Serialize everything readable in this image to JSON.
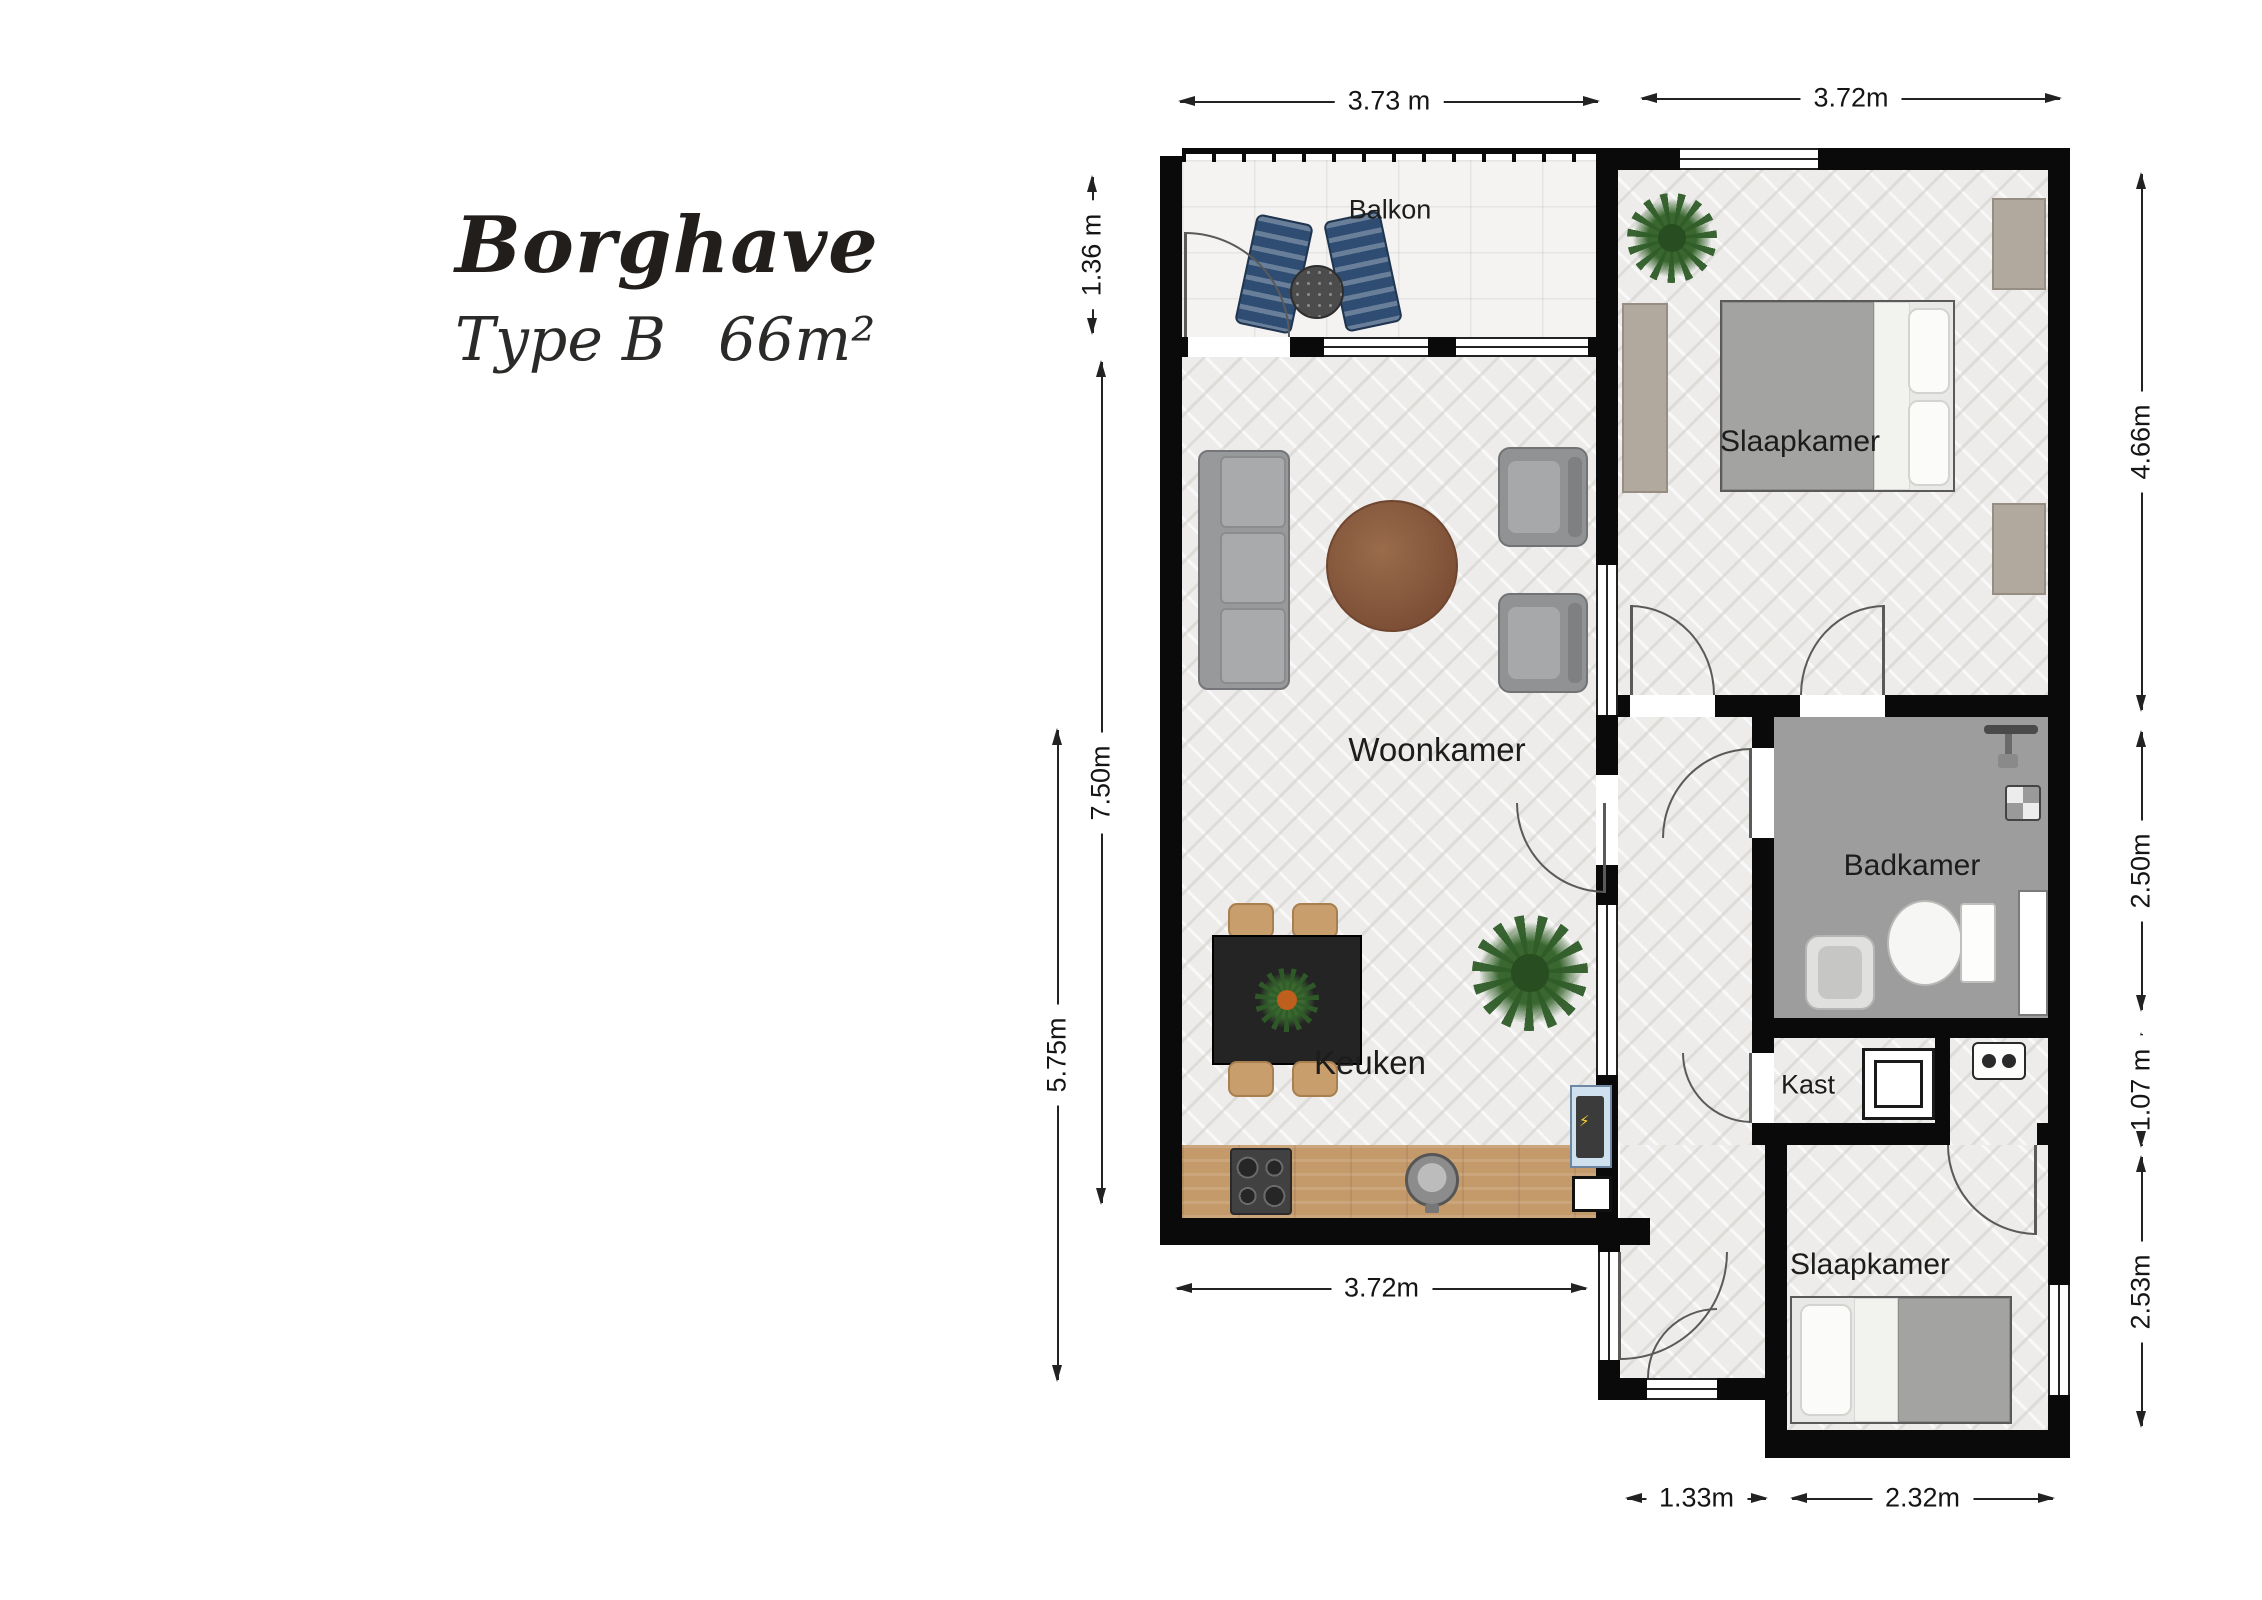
{
  "header": {
    "title": "Borghave",
    "type_label": "Type B",
    "area_label": "66m²"
  },
  "rooms": {
    "balkon": "Balkon",
    "slaapkamer_1": "Slaapkamer",
    "woonkamer": "Woonkamer",
    "keuken": "Keuken",
    "badkamer": "Badkamer",
    "kast": "Kast",
    "slaapkamer_2": "Slaapkamer"
  },
  "dims": {
    "top_balcony": "3.73 m",
    "top_bedroom": "3.72m",
    "left_balcony": "1.36 m",
    "left_living": "7.50m",
    "left_kitchen": "5.75m",
    "right_bedroom1": "4.66m",
    "right_bathroom": "2.50m",
    "right_closet": "1.07 m",
    "right_bedroom2": "2.53m",
    "bottom_kitchen": "3.72m",
    "bottom_hall": "1.33m",
    "bottom_bedroom2": "2.32m"
  }
}
